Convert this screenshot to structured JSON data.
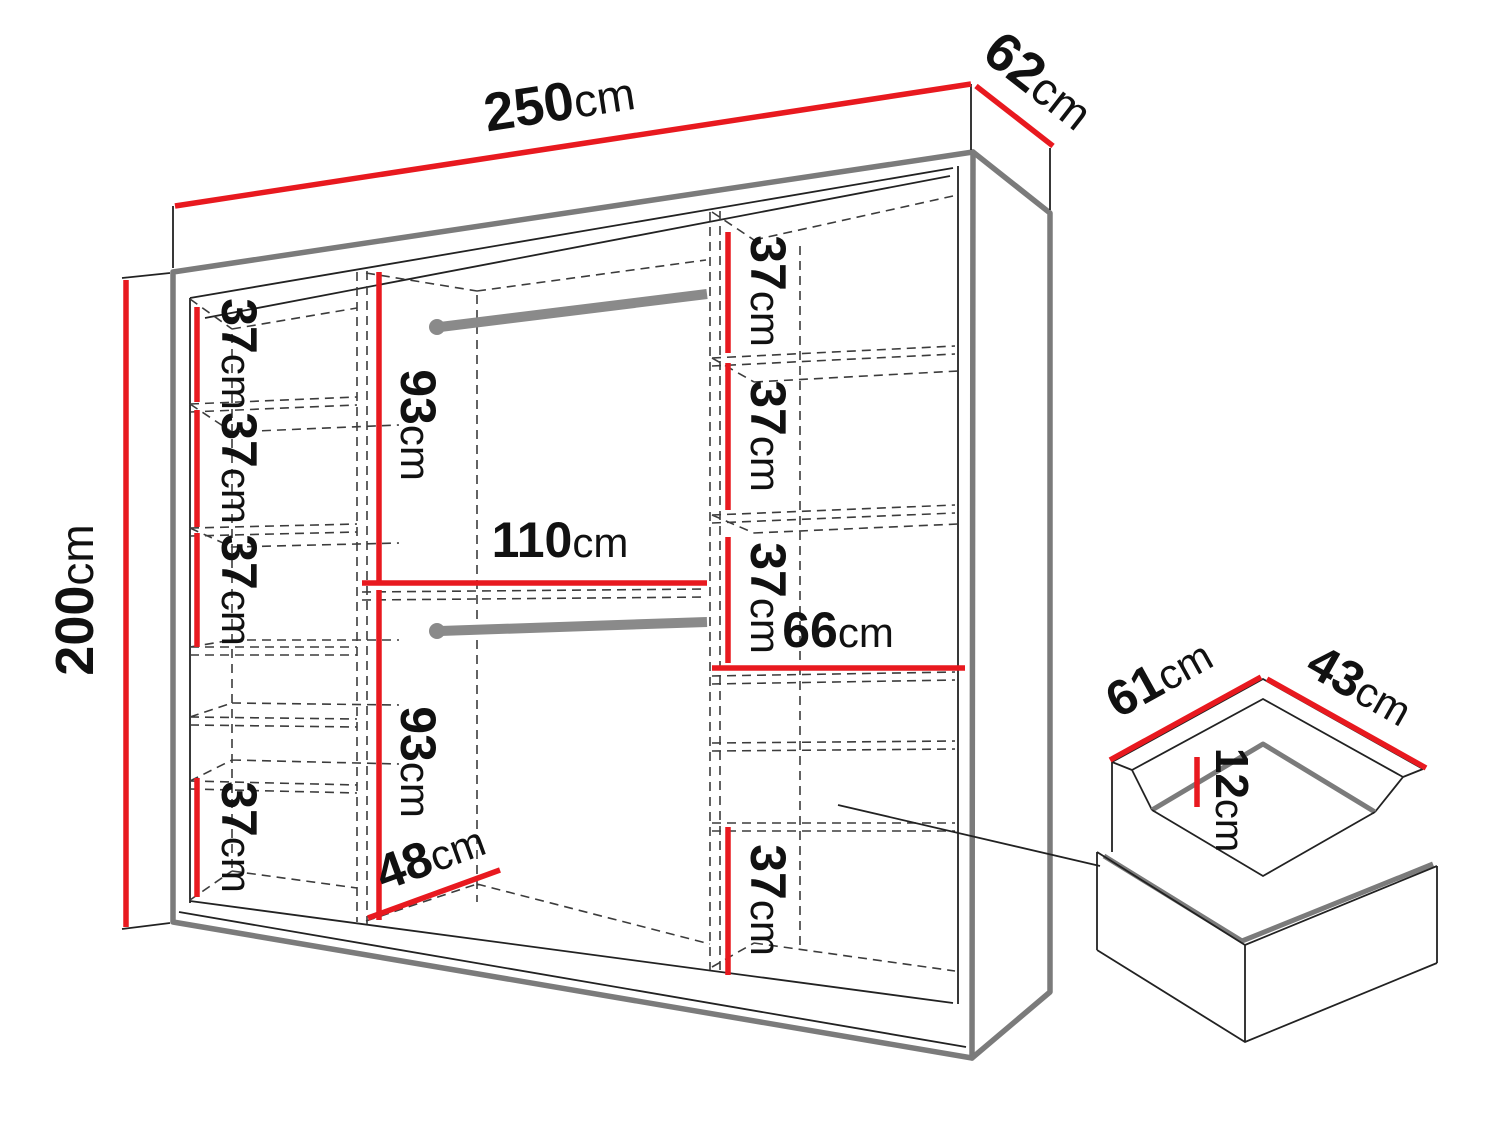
{
  "diagram": {
    "type": "furniture-dimension-drawing",
    "subject": "wardrobe with internal shelves, hanging rails and drawer detail",
    "colors": {
      "dimension_red": "#e8191f",
      "edge_gray": "#7b7b7b",
      "line_dark": "#222222"
    },
    "labels": {
      "width": {
        "value": "250",
        "unit": "cm"
      },
      "depth": {
        "value": "62",
        "unit": "cm"
      },
      "height": {
        "value": "200",
        "unit": "cm"
      },
      "left_shelf_1": {
        "value": "37",
        "unit": "cm"
      },
      "left_shelf_2": {
        "value": "37",
        "unit": "cm"
      },
      "left_shelf_3": {
        "value": "37",
        "unit": "cm"
      },
      "left_shelf_4": {
        "value": "37",
        "unit": "cm"
      },
      "hang_upper": {
        "value": "93",
        "unit": "cm"
      },
      "hang_lower": {
        "value": "93",
        "unit": "cm"
      },
      "mid_width": {
        "value": "110",
        "unit": "cm"
      },
      "floor_depth": {
        "value": "48",
        "unit": "cm"
      },
      "right_shelf_1": {
        "value": "37",
        "unit": "cm"
      },
      "right_shelf_2": {
        "value": "37",
        "unit": "cm"
      },
      "right_shelf_3": {
        "value": "37",
        "unit": "cm"
      },
      "right_width": {
        "value": "66",
        "unit": "cm"
      },
      "right_bottom": {
        "value": "37",
        "unit": "cm"
      },
      "drawer_depth": {
        "value": "61",
        "unit": "cm"
      },
      "drawer_width": {
        "value": "43",
        "unit": "cm"
      },
      "drawer_height": {
        "value": "12",
        "unit": "cm"
      }
    }
  }
}
